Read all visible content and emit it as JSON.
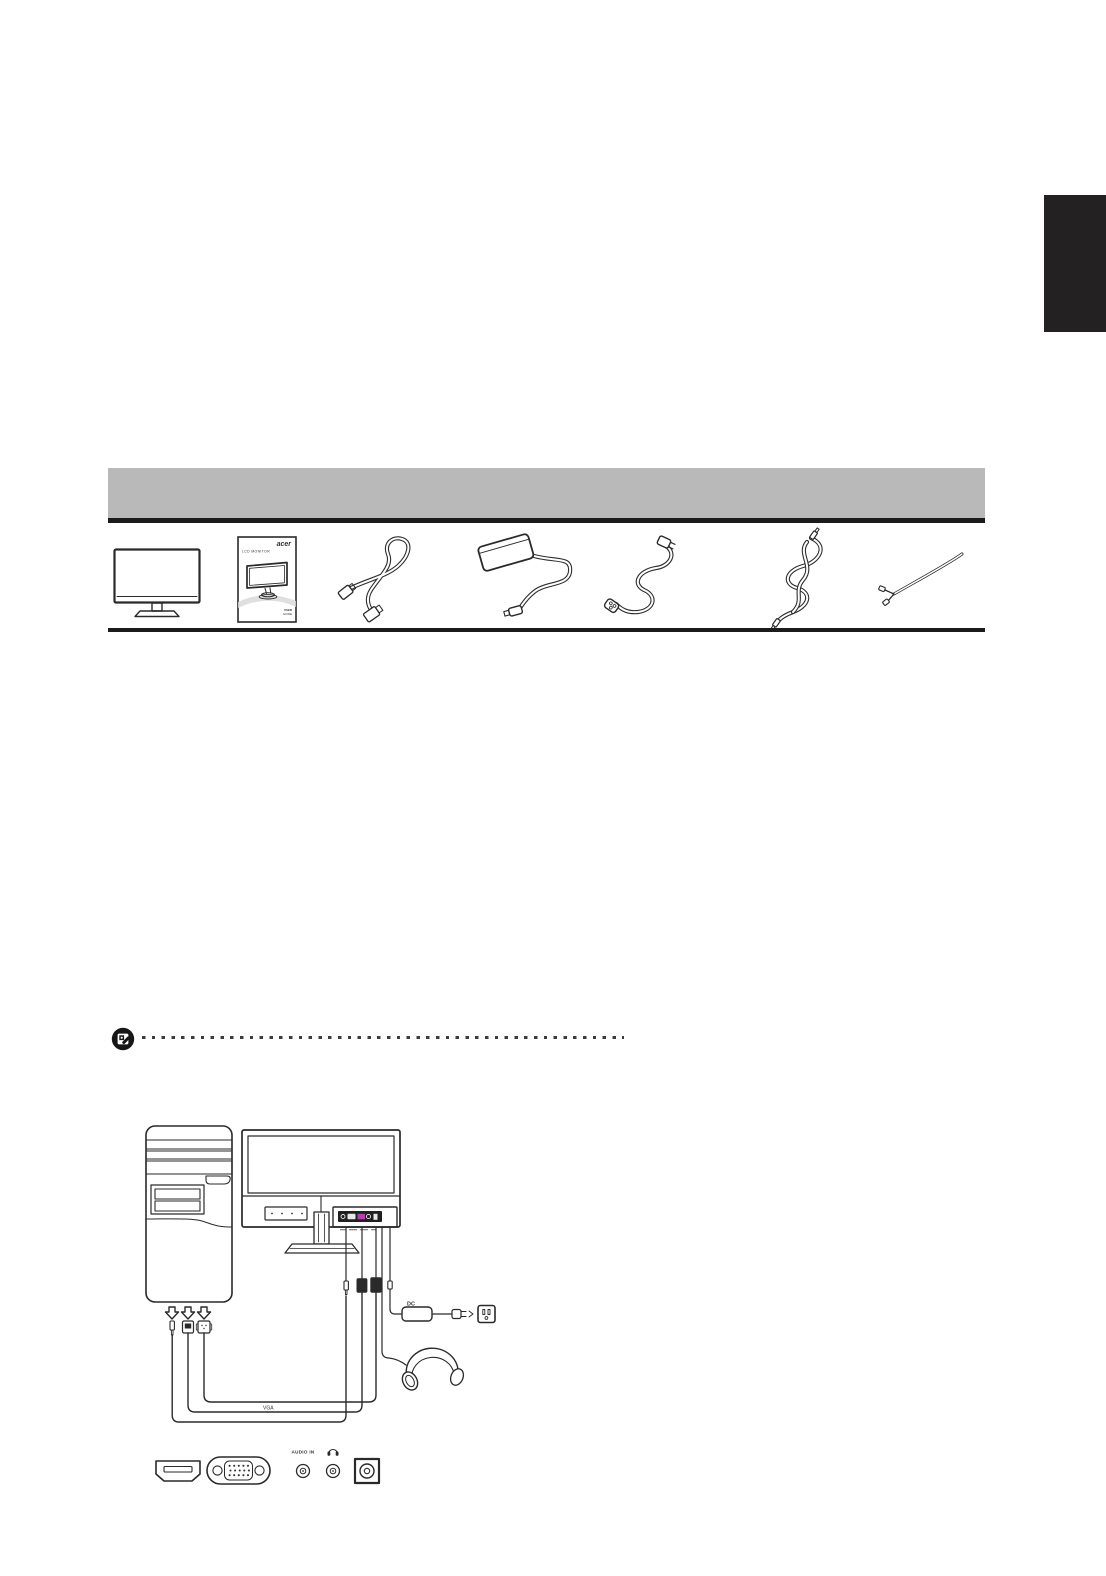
{
  "page": {
    "background": "#ffffff",
    "side_tab_color": "#242122",
    "section_bar_color": "#b9b9b9",
    "rule_color": "#1b1b1b"
  },
  "packing": {
    "items": [
      {
        "icon": "monitor-icon"
      },
      {
        "icon": "user-guide-icon",
        "brand": "acer",
        "title": "LCD MONITOR",
        "footer1": "USER",
        "footer2": "GUIDE"
      },
      {
        "icon": "vga-cable-icon"
      },
      {
        "icon": "power-adapter-icon"
      },
      {
        "icon": "power-cord-icon"
      },
      {
        "icon": "audio-cable-icon"
      },
      {
        "icon": "cable-icon"
      }
    ]
  },
  "note": {
    "icon": "note-icon"
  },
  "connection": {
    "adapter_label": "DC",
    "cable_label": "VGA",
    "audio_in_label": "AUDIO IN",
    "vga_port_color": "#b43fae"
  }
}
